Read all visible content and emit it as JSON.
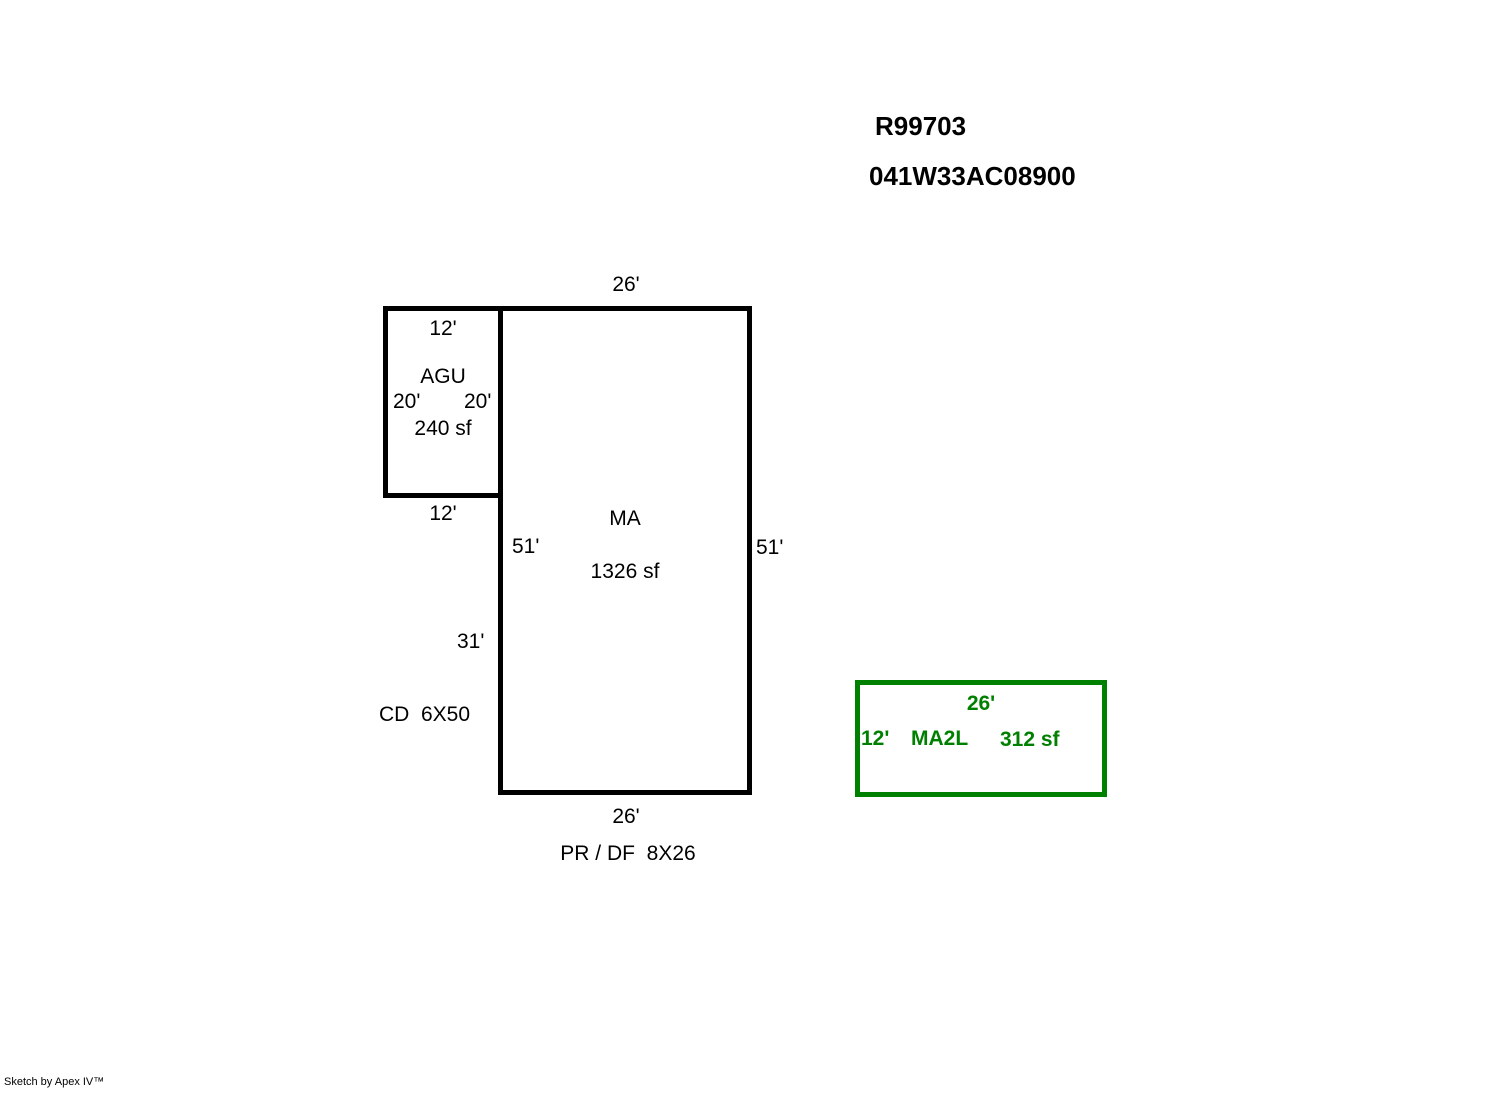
{
  "header": {
    "parcel_id": "R99703",
    "map_taxlot": "041W33AC08900"
  },
  "colors": {
    "outline": "#000000",
    "addition_outline": "#008000",
    "background": "#ffffff"
  },
  "areas": {
    "agu": {
      "label": "AGU",
      "sqft": "240 sf",
      "dim_top": "12'",
      "dim_left": "20'",
      "dim_right": "20'",
      "dim_bottom": "12'"
    },
    "ma": {
      "label": "MA",
      "sqft": "1326 sf",
      "dim_top": "26'",
      "dim_left_upper": "51'",
      "dim_left_lower": "31'",
      "dim_right": "51'",
      "dim_bottom": "26'"
    },
    "ma2l": {
      "label": "MA2L",
      "sqft": "312 sf",
      "dim_top": "26'",
      "dim_left": "12'"
    }
  },
  "annotations": {
    "cd": "CD  6X50",
    "pr_df": "PR / DF  8X26"
  },
  "footer": {
    "credit": "Sketch by Apex IV™"
  }
}
